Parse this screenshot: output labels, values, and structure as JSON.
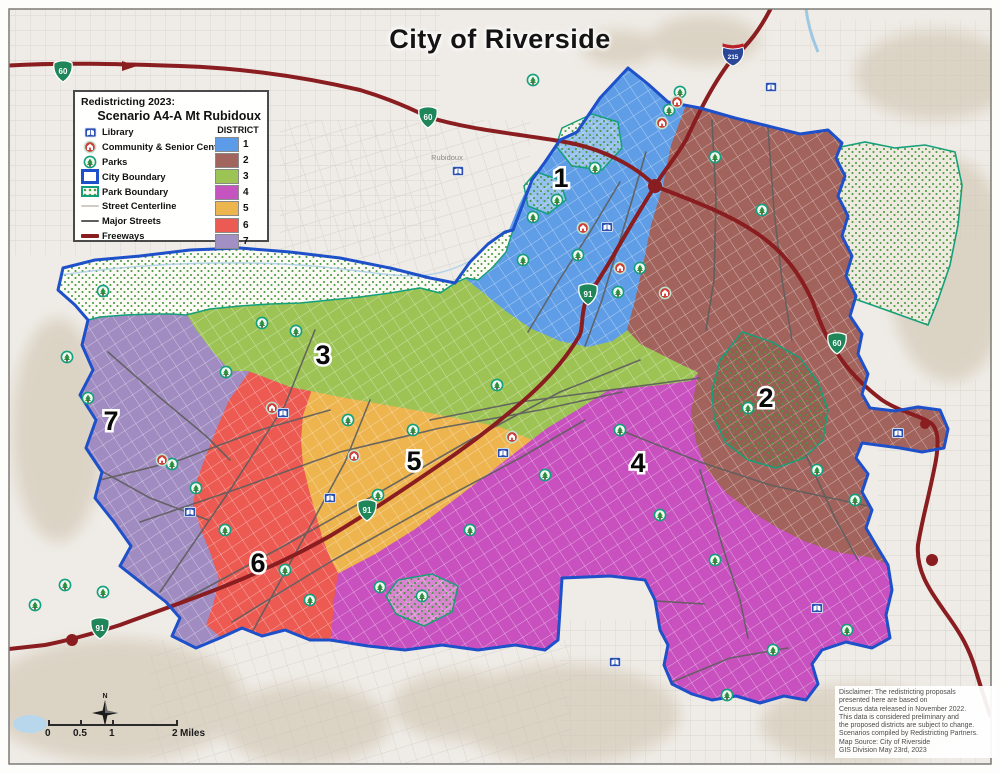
{
  "title": "City of Riverside",
  "legend": {
    "heading_line1": "Redistricting 2023:",
    "heading_line2": "Scenario A4-A Mt Rubidoux",
    "district_header": "DISTRICT",
    "items": [
      {
        "label": "Library",
        "icon": "library-icon"
      },
      {
        "label": "Community & Senior Centers",
        "icon": "community-center-icon"
      },
      {
        "label": "Parks",
        "icon": "park-icon"
      },
      {
        "label": "City Boundary",
        "icon": "city-boundary-swatch"
      },
      {
        "label": "Park Boundary",
        "icon": "park-boundary-swatch"
      },
      {
        "label": "Street Centerline",
        "icon": "street-centerline-swatch"
      },
      {
        "label": "Major Streets",
        "icon": "major-streets-swatch"
      },
      {
        "label": "Freeways",
        "icon": "freeways-swatch"
      }
    ],
    "districts": [
      {
        "number": "1",
        "color": "#5c9be7"
      },
      {
        "number": "2",
        "color": "#a2655e"
      },
      {
        "number": "3",
        "color": "#9cc455"
      },
      {
        "number": "4",
        "color": "#c654c0"
      },
      {
        "number": "5",
        "color": "#edb54e"
      },
      {
        "number": "6",
        "color": "#ec5b53"
      },
      {
        "number": "7",
        "color": "#a28fc3"
      }
    ]
  },
  "map": {
    "district_labels": [
      {
        "number": "1",
        "x": 561,
        "y": 187
      },
      {
        "number": "2",
        "x": 766,
        "y": 407
      },
      {
        "number": "3",
        "x": 323,
        "y": 364
      },
      {
        "number": "4",
        "x": 638,
        "y": 472
      },
      {
        "number": "5",
        "x": 414,
        "y": 470
      },
      {
        "number": "6",
        "x": 258,
        "y": 572
      },
      {
        "number": "7",
        "x": 111,
        "y": 430
      }
    ],
    "route_shields": [
      {
        "type": "state",
        "label": "60",
        "x": 63,
        "y": 71
      },
      {
        "type": "state",
        "label": "60",
        "x": 428,
        "y": 117
      },
      {
        "type": "state",
        "label": "60",
        "x": 837,
        "y": 343
      },
      {
        "type": "interstate",
        "label": "215",
        "x": 733,
        "y": 55
      },
      {
        "type": "state",
        "label": "91",
        "x": 588,
        "y": 294
      },
      {
        "type": "state",
        "label": "91",
        "x": 367,
        "y": 510
      },
      {
        "type": "state",
        "label": "91",
        "x": 100,
        "y": 628
      }
    ],
    "place_labels": [
      {
        "text": "Rubidoux",
        "x": 447,
        "y": 160
      }
    ],
    "parks": [
      [
        533,
        80
      ],
      [
        680,
        92
      ],
      [
        669,
        110
      ],
      [
        715,
        157
      ],
      [
        762,
        210
      ],
      [
        595,
        168
      ],
      [
        557,
        200
      ],
      [
        533,
        217
      ],
      [
        523,
        260
      ],
      [
        578,
        255
      ],
      [
        618,
        292
      ],
      [
        640,
        268
      ],
      [
        103,
        291
      ],
      [
        262,
        323
      ],
      [
        296,
        331
      ],
      [
        67,
        357
      ],
      [
        88,
        398
      ],
      [
        226,
        372
      ],
      [
        172,
        464
      ],
      [
        196,
        488
      ],
      [
        225,
        530
      ],
      [
        285,
        570
      ],
      [
        310,
        600
      ],
      [
        35,
        605
      ],
      [
        65,
        585
      ],
      [
        103,
        592
      ],
      [
        348,
        420
      ],
      [
        378,
        495
      ],
      [
        413,
        430
      ],
      [
        470,
        530
      ],
      [
        545,
        475
      ],
      [
        620,
        430
      ],
      [
        660,
        515
      ],
      [
        715,
        560
      ],
      [
        748,
        408
      ],
      [
        817,
        470
      ],
      [
        855,
        500
      ],
      [
        773,
        650
      ],
      [
        847,
        630
      ],
      [
        727,
        695
      ],
      [
        380,
        587
      ],
      [
        422,
        596
      ],
      [
        497,
        385
      ]
    ],
    "libraries": [
      [
        458,
        171
      ],
      [
        771,
        87
      ],
      [
        607,
        227
      ],
      [
        283,
        413
      ],
      [
        190,
        512
      ],
      [
        330,
        498
      ],
      [
        503,
        453
      ],
      [
        817,
        608
      ],
      [
        615,
        662
      ],
      [
        898,
        433
      ]
    ],
    "community_centers": [
      [
        677,
        102
      ],
      [
        662,
        123
      ],
      [
        583,
        228
      ],
      [
        620,
        268
      ],
      [
        665,
        293
      ],
      [
        272,
        408
      ],
      [
        162,
        460
      ],
      [
        354,
        456
      ],
      [
        512,
        437
      ]
    ]
  },
  "scale_bar": {
    "tick_labels": [
      "0",
      "0.5",
      "1",
      "2"
    ],
    "unit": "Miles"
  },
  "compass": {
    "label": "N"
  },
  "disclaimer": {
    "lines": [
      "Disclaimer: The redistricting proposals",
      "presented here are based on",
      "Census data released in November 2022.",
      "This data is considered preliminary and",
      "the proposed districts are subject to change.",
      "Scenarios compiled by Redistricting Partners.",
      "Map Source: City of Riverside",
      "GIS Division May 23rd, 2023"
    ]
  },
  "colors": {
    "city_boundary": "#1d50c9",
    "park_boundary": "#12a07c",
    "freeway": "#8a1d20",
    "major_street": "#5e5e5e",
    "street_centerline": "#cfccc7",
    "background": "#efece7",
    "district1": "#5f9ee6",
    "district2": "#a2635c",
    "district3": "#9dc355",
    "district4": "#c851bf",
    "district5": "#eeb44e",
    "district6": "#ec5a52",
    "district7": "#a18cc2"
  }
}
